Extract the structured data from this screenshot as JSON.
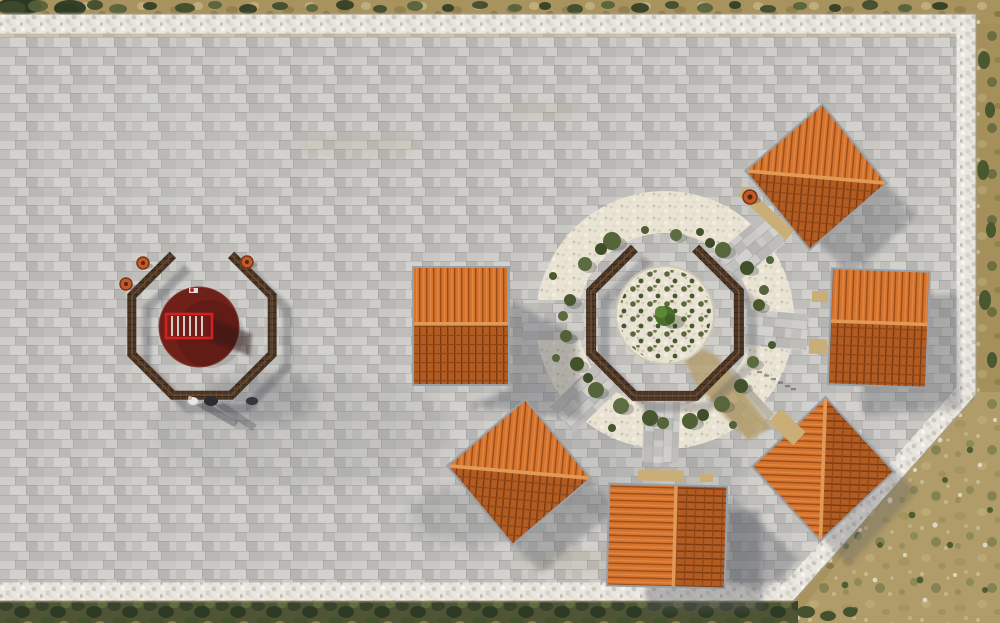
{
  "scene": {
    "type": "aerial-photograph",
    "description": "Top-down aerial view of a limestone-paved plaza: six square pavilions with orange clay-tile gable roofs ring a circular white-gravel garden planted with shrubs and a central tree, enclosed by an octagonal timber bench ring with a gap on its north side; to the west sits a second octagonal timber bench enclosure around a dark-red circular platform holding a red slatted frame; the plaza is bordered by a white rubble-stone wall with dry tan scrubland beyond; low sun from the upper-left casts shadows toward the lower-right.",
    "people_visible": 2,
    "pavilion_count": 6,
    "structures": {
      "west_enclosure": "octagonal bench ring with north gap, dark red circular platform, red slatted frame, three clay pots",
      "central_garden": "octagonal bench ring with north gap around white gravel planting circle, shrub ring, radial paved paths",
      "pavilions": [
        "west",
        "northeast",
        "east",
        "southeast",
        "south",
        "southwest"
      ]
    }
  },
  "colors": {
    "pavement": "#c6c5c2",
    "stone_wall": "#e9e6e0",
    "terrain_scrub": "#a8935f",
    "hedge_green": "#4e5434",
    "roof_light": "#d6742e",
    "roof_dark": "#b35c22",
    "roof_ridge": "#e19a55",
    "eave_gray": "#99a0a7",
    "bench_wood": "#4a3424",
    "gravel_white": "#e9e3d4",
    "platform_maroon": "#6e2019",
    "frame_red": "#d42020",
    "deck_wood": "#caae77",
    "pot_clay": "#c05a28",
    "tree_green": "#4a6f2a",
    "shadow": "#565861"
  }
}
